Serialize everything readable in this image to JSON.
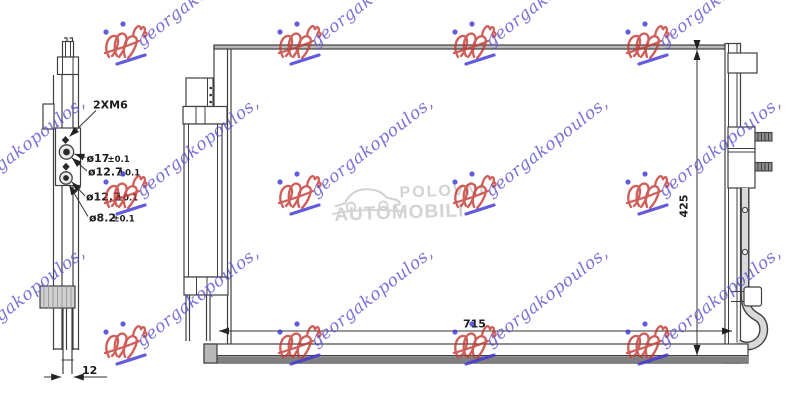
{
  "drawing": {
    "line_color": "#3f3f3f"
  },
  "side_view": {
    "bolt_label": "2XM6",
    "dims": [
      {
        "value": "ø17",
        "tol": "±0.1"
      },
      {
        "value": "ø12.7",
        "tol": "±0.1"
      },
      {
        "value": "ø12.7",
        "tol": "±0.1"
      },
      {
        "value": "ø8.2",
        "tol": "±0.1"
      }
    ],
    "bottom_dim": "12"
  },
  "front_view": {
    "height_dim": "425",
    "width_dim": "715"
  },
  "center_watermark": {
    "line1": "POLOVNI",
    "line2": "AUTOMOBILI",
    "color": "#d3d3d3"
  },
  "watermark": {
    "text": "georgakopoulos,",
    "text_color": "#5b4fd0",
    "logo_color": "#c53a34",
    "accent_color": "#4238d6",
    "positions": [
      [
        126,
        45
      ],
      [
        300,
        45
      ],
      [
        475,
        45
      ],
      [
        648,
        45
      ],
      [
        -48,
        195
      ],
      [
        126,
        195
      ],
      [
        300,
        195
      ],
      [
        475,
        195
      ],
      [
        648,
        195
      ],
      [
        -48,
        345
      ],
      [
        126,
        345
      ],
      [
        300,
        345
      ],
      [
        475,
        345
      ],
      [
        648,
        345
      ]
    ]
  }
}
